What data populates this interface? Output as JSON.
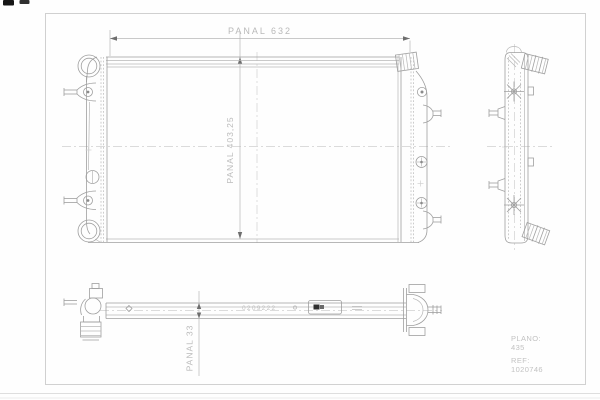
{
  "drawing": {
    "labels": {
      "dim_width": "PANAL  632",
      "dim_height": "PANAL 403,25",
      "dim_depth": "PANAL 33"
    },
    "stamp_number": "0209222",
    "title_block": {
      "plano_label": "PLANO:",
      "plano_value": "435",
      "ref_label": "REF:",
      "ref_value": "1020746"
    },
    "colors": {
      "line": "#9f9f9f",
      "light_line": "#b7b7b7",
      "centerline": "#d0d0d0",
      "dim_text": "#b9b9b9",
      "frame": "#cccccc",
      "stamp_text": "#c4c4c4",
      "arrow": "#6e6e6e"
    }
  }
}
